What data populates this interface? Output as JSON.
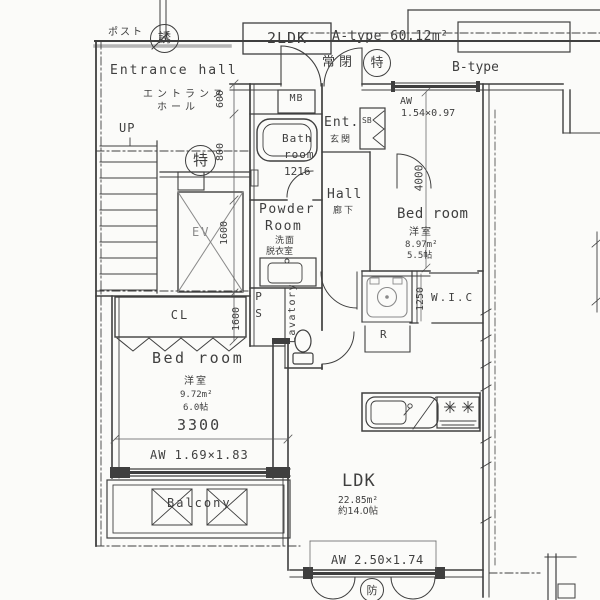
{
  "palette": {
    "bg": "#fbfbf9",
    "ink": "#3f3f3f",
    "gray": "#8a8a8a"
  },
  "title": {
    "unit_badge": "2LDK",
    "unit_title": "A-type 60.12m²",
    "adjacent_unit": "B-type"
  },
  "common_area": {
    "post": "ポスト",
    "guide_badge": "誘",
    "entrance_en": "Entrance hall",
    "entrance_jp_1": "エントランス",
    "entrance_jp_2": "ホール",
    "up": "UP",
    "stair_badge": "特",
    "elevator": "EV"
  },
  "entry": {
    "always_closed": "常閉",
    "ent_badge": "特",
    "mb": "MB",
    "ent_en": "Ent.",
    "ent_jp": "玄関",
    "sb": "SB"
  },
  "bath": {
    "line1": "Bath",
    "line2": "room",
    "size": "1216"
  },
  "powder": {
    "line1": "Powder",
    "line2": "Room",
    "jp_1": "洗面",
    "jp_2": "脱衣室"
  },
  "ps": "PS",
  "lavatory": "Lavatory",
  "hall": {
    "en": "Hall",
    "jp": "廊下"
  },
  "bedroom_east": {
    "name": "Bed room",
    "jp": "洋室",
    "area": "8.97m²",
    "tatami": "5.5帖",
    "window": "AW",
    "window_size": "1.54×0.97"
  },
  "wic": "W.I.C",
  "refrigerator": "R",
  "closet": "CL",
  "bedroom_west": {
    "name": "Bed room",
    "jp": "洋室",
    "area": "9.72m²",
    "tatami": "6.0帖",
    "window": "AW 1.69×1.83"
  },
  "balcony": "Balcony",
  "ldk": {
    "name": "LDK",
    "area": "22.85m²",
    "tatami": "約14.0帖",
    "window": "AW 2.50×1.74",
    "fire_badge": "防"
  },
  "dimensions": {
    "d600": "600",
    "d800": "800",
    "d1600_ev": "1600",
    "d1600_cl": "1600",
    "d4000": "4000",
    "d1250": "1250",
    "d3300": "3300"
  }
}
